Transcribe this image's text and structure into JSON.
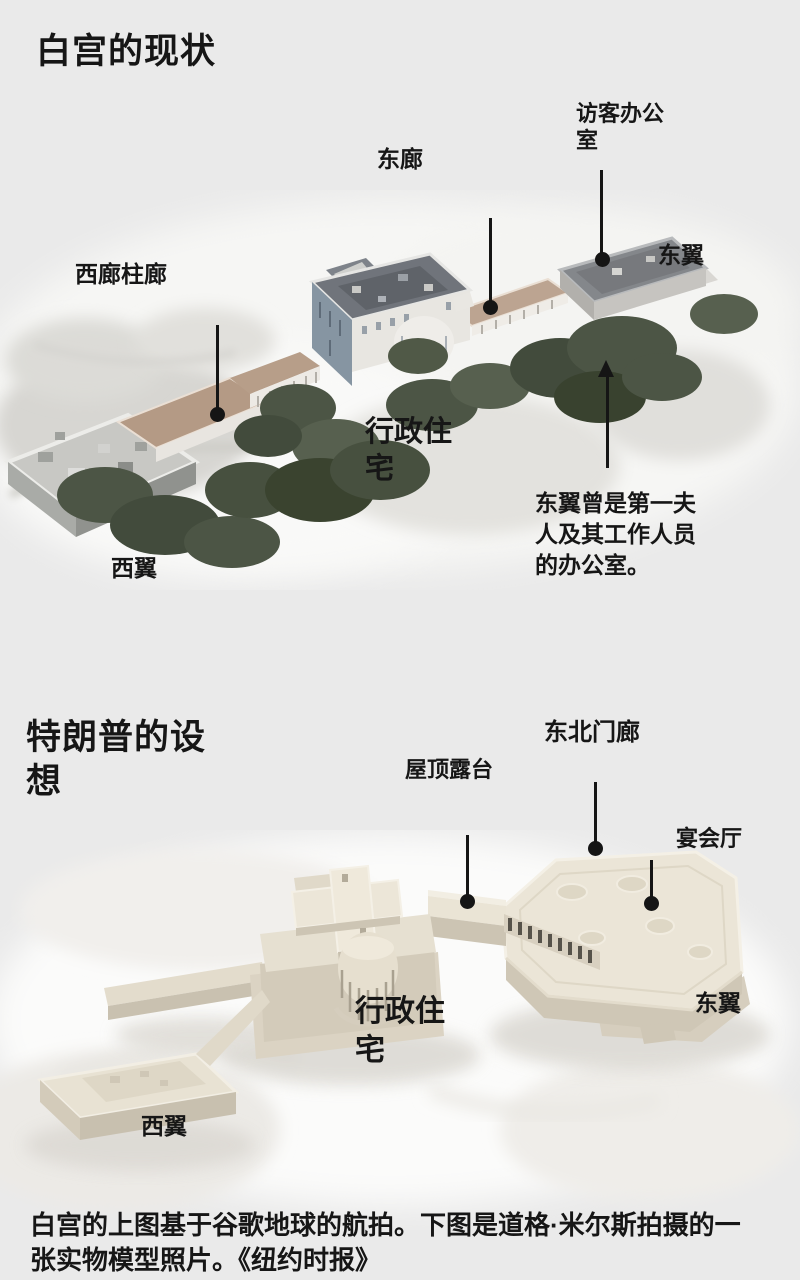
{
  "colors": {
    "bg": "#eaeaea",
    "ink": "#161616",
    "line": "#151515",
    "tree_green": "#4c5545",
    "colonnade_tan": "#b49a85",
    "residence_wall_blue": "#8695a2",
    "residence_roof_gray": "#70747b",
    "model_cream": "#ebe5d7",
    "model_shadow_cream": "#cfc7b6"
  },
  "current": {
    "title": "白宫的现状",
    "labels": {
      "visitor_office": "访客办公室",
      "east_colonnade": "东廊",
      "east_wing": "东翼",
      "west_colonnade": "西廊柱廊",
      "executive_residence": "行政住宅",
      "west_wing": "西翼"
    },
    "note": "东翼曾是第一夫人及其工作人员的办公室。"
  },
  "proposal": {
    "title": "特朗普的设想",
    "labels": {
      "northeast_portico": "东北门廊",
      "rooftop_terrace": "屋顶露台",
      "ballroom": "宴会厅",
      "executive_residence": "行政住宅",
      "east_wing": "东翼",
      "west_wing": "西翼"
    }
  },
  "caption": "白宫的上图基于谷歌地球的航拍。下图是道格·米尔斯拍摄的一张实物模型照片。《纽约时报》"
}
